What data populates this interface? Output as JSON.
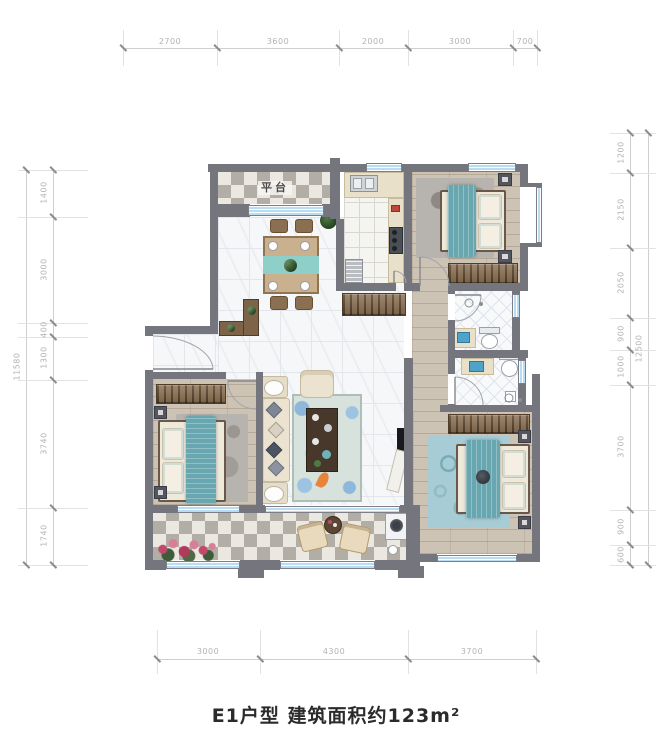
{
  "title": "E1户型 建筑面积约123m²",
  "labels": {
    "platform": "平台"
  },
  "dimensions": {
    "top": [
      "2700",
      "3600",
      "2000",
      "3000",
      "700"
    ],
    "bottom": [
      "3000",
      "4300",
      "3700"
    ],
    "left": [
      "1400",
      "3000",
      "400",
      "1300",
      "3740",
      "1740"
    ],
    "left_total": "11580",
    "right": [
      "1200",
      "2150",
      "2050",
      "900",
      "1000",
      "3700",
      "900",
      "600"
    ],
    "right_total": "12500"
  },
  "colors": {
    "wall": "#75757d",
    "window_glass": "#b9dcf2",
    "accent_teal": "#68a6b0",
    "wood_floor": "#cdc3b5",
    "dimension_text": "#b2b2b2"
  }
}
